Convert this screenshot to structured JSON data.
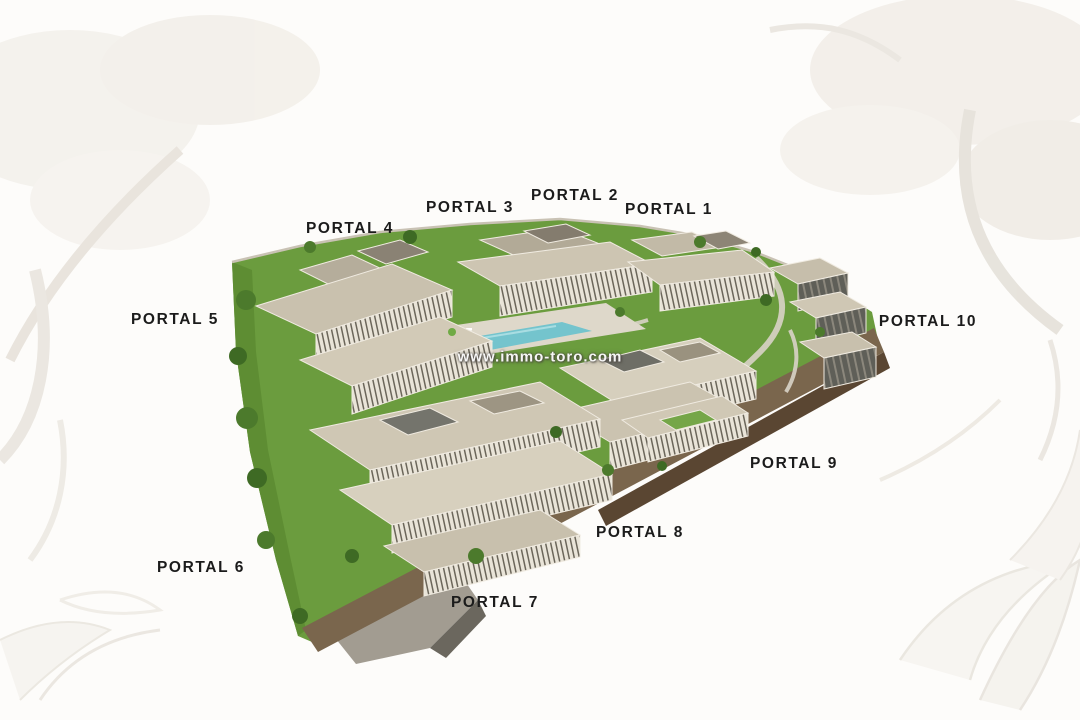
{
  "site": {
    "watermark": "www.immo-toro.com",
    "portals": [
      {
        "id": 1,
        "label": "PORTAL 1"
      },
      {
        "id": 2,
        "label": "PORTAL 2"
      },
      {
        "id": 3,
        "label": "PORTAL 3"
      },
      {
        "id": 4,
        "label": "PORTAL 4"
      },
      {
        "id": 5,
        "label": "PORTAL 5"
      },
      {
        "id": 6,
        "label": "PORTAL 6"
      },
      {
        "id": 7,
        "label": "PORTAL 7"
      },
      {
        "id": 8,
        "label": "PORTAL 8"
      },
      {
        "id": 9,
        "label": "PORTAL 9"
      },
      {
        "id": 10,
        "label": "PORTAL 10"
      }
    ]
  },
  "colors": {
    "label_text": "#1b1b1b",
    "watermark_text": "#ffffff",
    "grass": "#6b9c3e",
    "grass_shade": "#5e8d33",
    "road": "#7a664d",
    "retaining_wall": "#5a4632",
    "building_roof": "#cdc5b2",
    "building_face": "#a89e8a",
    "pool": "#74c4cd",
    "background": "#fdfcfa"
  }
}
